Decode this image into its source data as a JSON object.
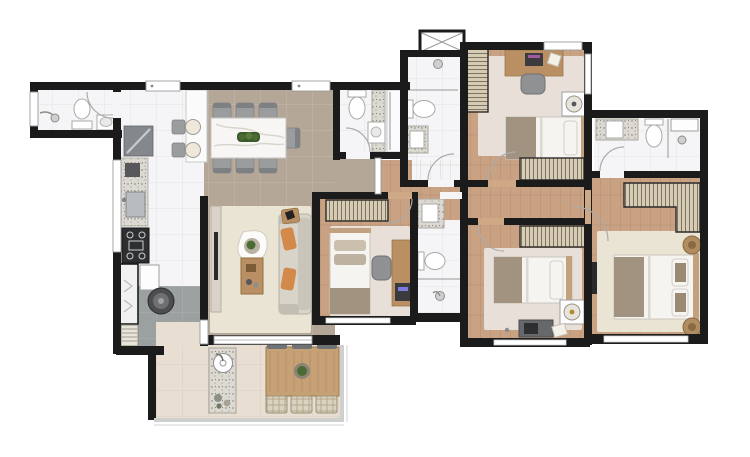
{
  "plan": {
    "kind": "apartment-floor-plan",
    "view": "top-down-rendered",
    "labels_visible": "none"
  },
  "palette": {
    "wall": "#1b1b1b",
    "wood": "#c9a284",
    "woodLight": "#d4b294",
    "taupe": "#b4a798",
    "tile": "#f5f5f7",
    "tileBeige": "#e8dfd2",
    "service": "#9ba0a1",
    "rugCream": "#eae4d5",
    "rugPink": "#e9dfd9",
    "granite": "#dad7d0",
    "woodFurn": "#b98f63",
    "grayFurn": "#9a9c9e",
    "darkFurn": "#55575a",
    "sofa": "#d8d4ca",
    "orange": "#d3894a",
    "green": "#4a6b33",
    "bedWhite": "#f6f4f0",
    "blanket": "#a29380",
    "wicker": "#d8cdbb",
    "glassRail": "#cfcfcf"
  },
  "rooms": {
    "bath_service": {
      "name": "Service bathroom",
      "furniture": [
        "shower",
        "toilet",
        "washbasin",
        "window"
      ]
    },
    "kitchen": {
      "name": "Kitchen",
      "furniture": [
        "dark counter",
        "granite sink counter",
        "cooktop",
        "refrigerator",
        "dishwasher",
        "breakfast counter",
        "two bar stools"
      ]
    },
    "service": {
      "name": "Laundry area",
      "furniture": [
        "washing machine",
        "towel shelf"
      ]
    },
    "dining": {
      "name": "Dining room",
      "furniture": [
        "marble dining table",
        "seven gray chairs",
        "plant centerpiece"
      ]
    },
    "living": {
      "name": "Living room",
      "furniture": [
        "tv sideboard",
        "tv",
        "sofa with orange cushions",
        "organic coffee table with plant",
        "wood coffee table",
        "side table",
        "rug",
        "sliding glass door"
      ]
    },
    "balcony": {
      "name": "Balcony / gourmet terrace",
      "furniture": [
        "granite counter with round sink",
        "potted plants",
        "wood table",
        "three gray chairs",
        "three wicker chairs",
        "plant centerpiece",
        "glass railing"
      ]
    },
    "hall": {
      "name": "Hall",
      "furniture": [
        "door leaf"
      ]
    },
    "corridor": {
      "name": "Bedroom corridor",
      "furniture": []
    },
    "bath_social_1": {
      "name": "Bathroom 1",
      "furniture": [
        "toilet",
        "granite washbasin",
        "glass shower stall"
      ]
    },
    "bath_social_2": {
      "name": "Bathroom 2",
      "furniture": [
        "shower",
        "toilet",
        "granite washbasin",
        "ventilation shaft"
      ]
    },
    "bath_3": {
      "name": "Bathroom 3",
      "furniture": [
        "granite washbasin",
        "toilet",
        "glass shower"
      ]
    },
    "bath_master": {
      "name": "Master bathroom",
      "furniture": [
        "granite washbasin",
        "toilet",
        "shower with shelf"
      ]
    },
    "bedroom_1": {
      "name": "Bedroom 1",
      "furniture": [
        "desk with chair",
        "side wardrobe",
        "single bed",
        "speaker table",
        "closet",
        "rug"
      ]
    },
    "bedroom_2": {
      "name": "Bedroom 2",
      "furniture": [
        "wardrobe",
        "single bed",
        "speaker table",
        "desk with chair",
        "rug"
      ]
    },
    "bedroom_3": {
      "name": "Bedroom 3",
      "furniture": [
        "wardrobe",
        "single bed",
        "desk with chair",
        "rug"
      ]
    },
    "master_bedroom": {
      "name": "Master suite",
      "furniture": [
        "L-shaped closet",
        "double bed",
        "two wicker poufs",
        "tv panel",
        "rug"
      ]
    }
  }
}
